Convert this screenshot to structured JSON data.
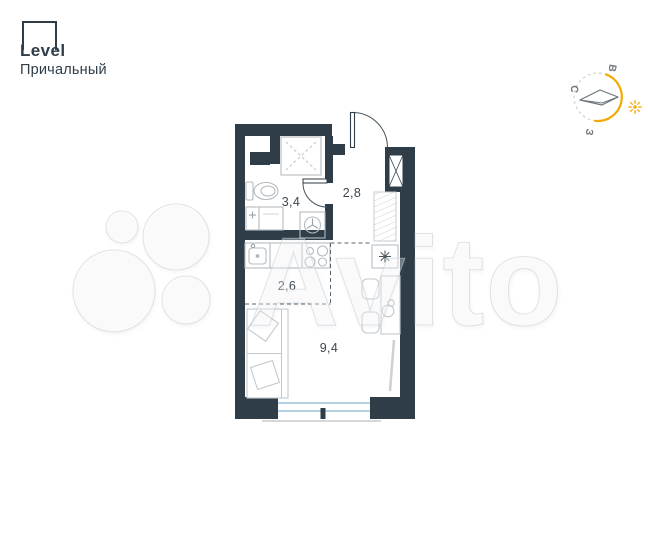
{
  "page": {
    "background": "#ffffff"
  },
  "branding": {
    "logo_text": "Level",
    "project_name": "Причальный",
    "brand_color": "#2e3d48"
  },
  "compass": {
    "direction_labels": {
      "east": "В",
      "north": "С",
      "west": "З"
    },
    "accent_color": "#f4a900",
    "dash_color": "#c9cdd0"
  },
  "watermark": {
    "text": "Avito"
  },
  "floor_plan": {
    "wall_color": "#2e3d48",
    "window_color": "#a9cbdc",
    "fixture_color": "#b4bbc0",
    "rooms": {
      "bathroom": {
        "area_label": "3,4"
      },
      "hallway": {
        "area_label": "2,8"
      },
      "kitchen": {
        "area_label": "2,6"
      },
      "living": {
        "area_label": "9,4"
      }
    }
  }
}
